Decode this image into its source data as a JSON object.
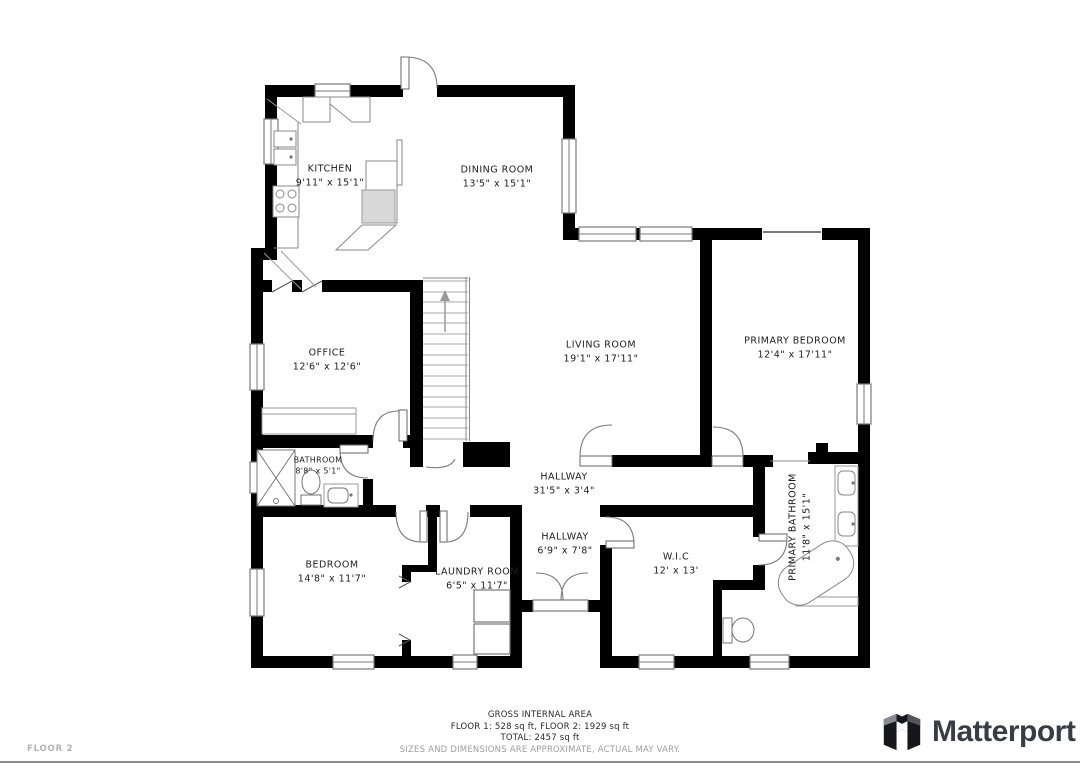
{
  "floor_label": "FLOOR 2",
  "rooms": [
    {
      "name": "KITCHEN",
      "dims": "9'11\" x 15'1\""
    },
    {
      "name": "DINING ROOM",
      "dims": "13'5\" x 15'1\""
    },
    {
      "name": "OFFICE",
      "dims": "12'6\" x 12'6\""
    },
    {
      "name": "LIVING ROOM",
      "dims": "19'1\" x 17'11\""
    },
    {
      "name": "PRIMARY BEDROOM",
      "dims": "12'4\" x 17'11\""
    },
    {
      "name": "BATHROOM",
      "dims": "8'8\" x 5'1\""
    },
    {
      "name": "HALLWAY",
      "dims": "31'5\" x 3'4\""
    },
    {
      "name": "HALLWAY",
      "dims": "6'9\" x 7'8\""
    },
    {
      "name": "BEDROOM",
      "dims": "14'8\" x 11'7\""
    },
    {
      "name": "LAUNDRY ROOM",
      "dims": "6'5\" x 11'7\""
    },
    {
      "name": "W.I.C",
      "dims": "12' x 13'"
    },
    {
      "name": "PRIMARY BATHROOM",
      "dims": "11'8\" x 15'1\""
    }
  ],
  "footer": {
    "gross_area_title": "GROSS INTERNAL AREA",
    "floors_line": "FLOOR 1: 528 sq ft, FLOOR 2: 1929 sq ft",
    "total_line": "TOTAL: 2457 sq ft",
    "disclaimer": "SIZES AND DIMENSIONS ARE APPROXIMATE, ACTUAL MAY VARY."
  },
  "brand": {
    "logo_text": "Matterport"
  },
  "colors": {
    "wall": "#000000",
    "thin_line": "#7a7a7a",
    "label": "#1d1d1d",
    "muted": "#9e9e9e",
    "brand_text": "#3b3b46"
  }
}
